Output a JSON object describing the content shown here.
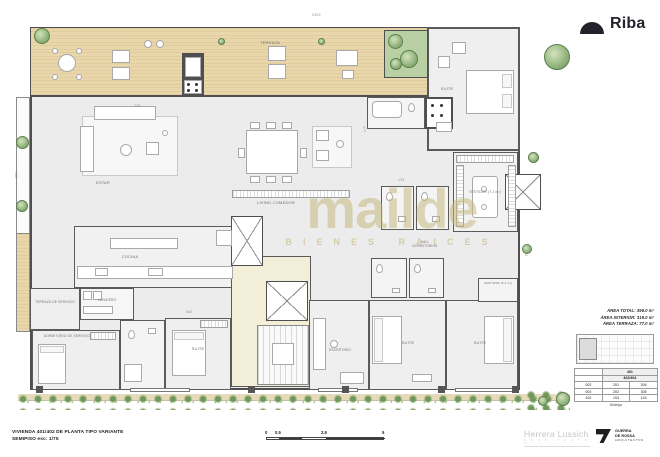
{
  "header": {
    "brand": "Riba"
  },
  "watermark": {
    "name": "mailde",
    "tagline": "BIENES RAICES"
  },
  "rooms": {
    "terraza": "TERRAZA",
    "estar": "ESTAR",
    "living": "LIVING COMEDOR",
    "cocina": "COCINA",
    "terraza_servicio": "TERRAZA DE SERVICIO",
    "lavadero": "LAVADERO",
    "dormitorio_servicio": "DORMITORIO DE SERVICIO",
    "suite_1": "SUITE",
    "escritorio": "ESCRITORIO",
    "suite_2": "SUITE",
    "suite_3": "SUITE",
    "suite_tr": "SUITE",
    "hall_dormitorios": "HALL DORMITORIOS",
    "vestidor_1": "VESTIDOR (7.2 m²)",
    "vestidor_2": "VESTIDOR (5.2 m²)"
  },
  "dimensions": {
    "top": "2325",
    "living": "728",
    "left": "345",
    "kitchen": "540",
    "right": "302",
    "bath_a": "177",
    "bath_b": "123"
  },
  "info": {
    "areas": [
      "ÁREA TOTAL: 396.0 m²",
      "ÁREA INTERIOR: 319.0 m²",
      "ÁREA TERRAZA: 77.0 m²"
    ],
    "table": {
      "col_header": "401",
      "col_subheader": "402/404",
      "rows": [
        [
          "002",
          "201",
          "304"
        ],
        [
          "003",
          "202",
          "305"
        ],
        [
          "102",
          "103",
          "124"
        ]
      ],
      "footer": "Bodega"
    }
  },
  "titleblock": {
    "line1": "VIVIENDA 401/402 DE PLANTA TIPO VARIANTE",
    "line2": "SEMIPISO esc: 1/75"
  },
  "scalebar": {
    "t0": "0",
    "t1": "0.5",
    "t2": "2.5",
    "t3": "5"
  },
  "logos": {
    "left_name": "Herrera Lussich",
    "left_sub": "A R Q U I T E C T O S",
    "right_line1": "GUERRA",
    "right_line2": "DE ROSSA",
    "right_line3": "ARQUITECTOS"
  }
}
